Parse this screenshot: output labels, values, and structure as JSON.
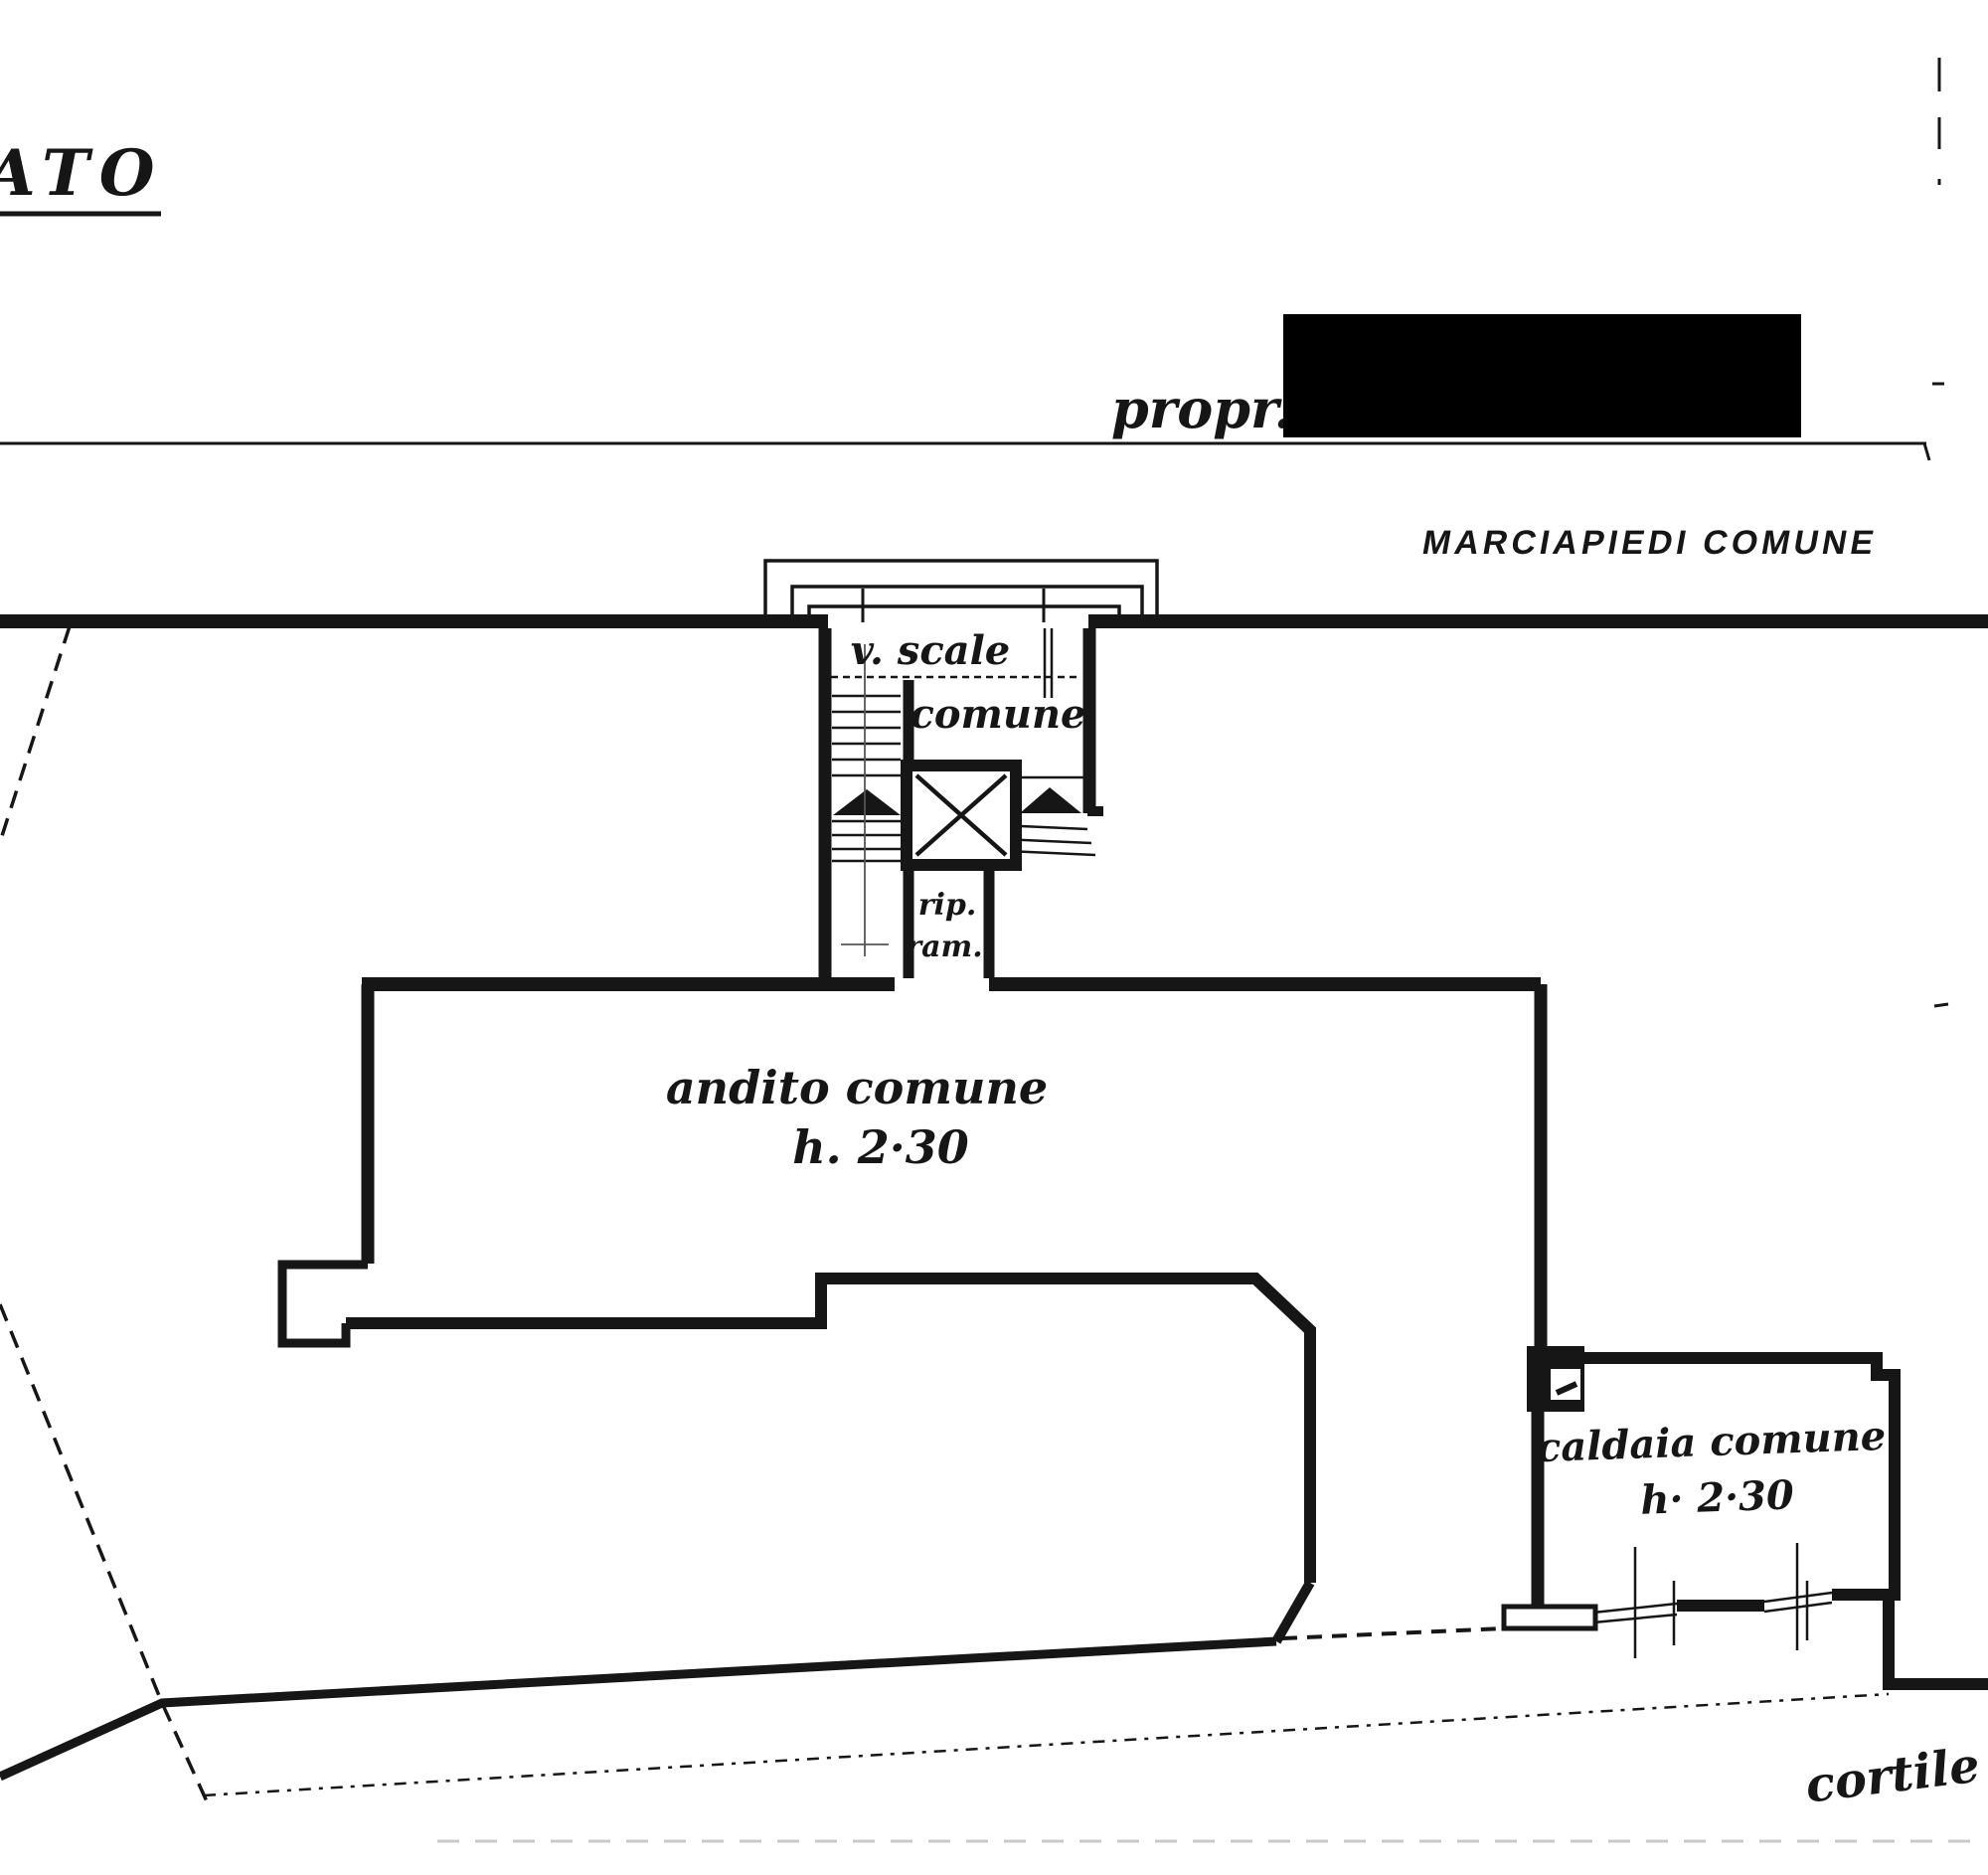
{
  "page": {
    "background": "#ffffff",
    "ink_color": "#161616",
    "redaction_color": "#000000"
  },
  "plan": {
    "title_fragment": "ATO",
    "owner_label": "propr.",
    "sidewalk_label": "MARCIAPIEDI COMUNE",
    "stairwell": {
      "line1": "v. scale",
      "line2": "comune"
    },
    "storage": {
      "line1": "rip.",
      "line2": "ram."
    },
    "hallway": {
      "line1": "andito comune",
      "line2": "h. 2·30"
    },
    "boiler": {
      "line1": "caldaia comune",
      "line2": "h· 2·30"
    },
    "courtyard_label": "cortile"
  }
}
